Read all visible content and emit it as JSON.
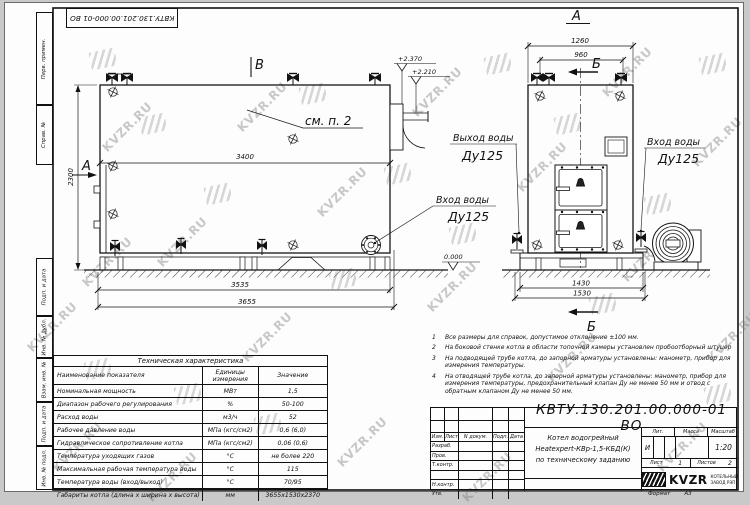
{
  "watermark": "KVZR.RU",
  "corner_stamp": "КВТУ.130.201.00.000-01 ВО",
  "margin_labels": [
    "Перв. примен.",
    "Справ. №",
    "Подп. и дата",
    "Инв. № дубл.",
    "Взам. инв. №",
    "Подп. и дата",
    "Инв. № подл."
  ],
  "drawing": {
    "view_b_mark": "В",
    "view_a_mark": "А",
    "right_view_title": "А",
    "section_b": "Б",
    "see_item": "см. п. 2",
    "level_top": "+2.370",
    "level_mid": "+2.210",
    "level_zero": "0.000",
    "dim_3400": "3400",
    "dim_2300": "2300",
    "dim_3535": "3535",
    "dim_3655": "3655",
    "dim_1260": "1260",
    "dim_960": "960",
    "dim_1430": "1430",
    "dim_1530": "1530",
    "inlet_label": "Вход воды",
    "inlet_dn": "Ду125",
    "outlet_label": "Выход воды",
    "outlet_dn": "Ду125"
  },
  "tech_table": {
    "title": "Техническая характеристика",
    "col_name": "Наименование показателя",
    "col_units": "Единицы измерения",
    "col_value": "Значение",
    "rows": [
      {
        "name": "Номинальная мощность",
        "units": "МВт",
        "value": "1,5"
      },
      {
        "name": "Диапазон рабочего регулирования",
        "units": "%",
        "value": "50-100"
      },
      {
        "name": "Расход воды",
        "units": "м3/ч",
        "value": "52"
      },
      {
        "name": "Рабочее давление воды",
        "units": "МПа (кгс/см2)",
        "value": "0,6 (6,0)"
      },
      {
        "name": "Гидравлическое сопротивление котла",
        "units": "МПа (кгс/см2)",
        "value": "0,06 (0,6)"
      },
      {
        "name": "Температура уходящих газов",
        "units": "°С",
        "value": "не более 220"
      },
      {
        "name": "Максимальная рабочая температура воды",
        "units": "°С",
        "value": "115"
      },
      {
        "name": "Температура воды (вход/выход)",
        "units": "°С",
        "value": "70/95"
      },
      {
        "name": "Габариты котла (длина х ширина х высота)",
        "units": "мм",
        "value": "3655х1530х2370"
      }
    ]
  },
  "notes": {
    "items": [
      {
        "num": "1",
        "text": "Все размеры для справок, допустимое отклонение ±100 мм."
      },
      {
        "num": "2",
        "text": "На боковой стенке котла в области топочной камеры установлен пробоотборный штуцер"
      },
      {
        "num": "3",
        "text": "На подводящей трубе котла, до запорной арматуры установлены: манометр, прибор для измерения температуры."
      },
      {
        "num": "4",
        "text": "На отводящей трубе котла, до запорной арматуры установлены: манометр, прибор для измерения температуры, предохранительный клапан Ду не менее 50 мм и отвод с обратным клапаном Ду не менее 50 мм."
      }
    ]
  },
  "title_block": {
    "doc_number": "КВТУ.130.201.00.000-01  ВО",
    "col_izm": "Изм.",
    "col_list": "Лист",
    "col_doc": "N докум.",
    "col_podp": "Подп.",
    "col_data": "Дата",
    "row_razrab": "Разраб.",
    "row_prov": "Пров.",
    "row_tkontr": "Т.контр.",
    "row_nkontr": "Н.контр.",
    "row_utv": "Утв.",
    "title_line1": "Котел водогрейный",
    "title_line2": "Heatexpert-КВр-1,5-КБД(К)",
    "title_line3": "по техническому заданию",
    "lit_label": "Лит.",
    "lit_value": "И",
    "mass_label": "Масса",
    "scale_label": "Масштаб",
    "scale_value": "1:20",
    "sheet_label": "Лист",
    "sheet_num": "1",
    "sheets_label": "Листов",
    "sheets_num": "2",
    "brand": "KVZR",
    "brand_line1": "КОТЕЛЬНЫЙ",
    "brand_line2": "ЗАВОД РЭП",
    "format_label": "Формат",
    "format_value": "А3"
  }
}
